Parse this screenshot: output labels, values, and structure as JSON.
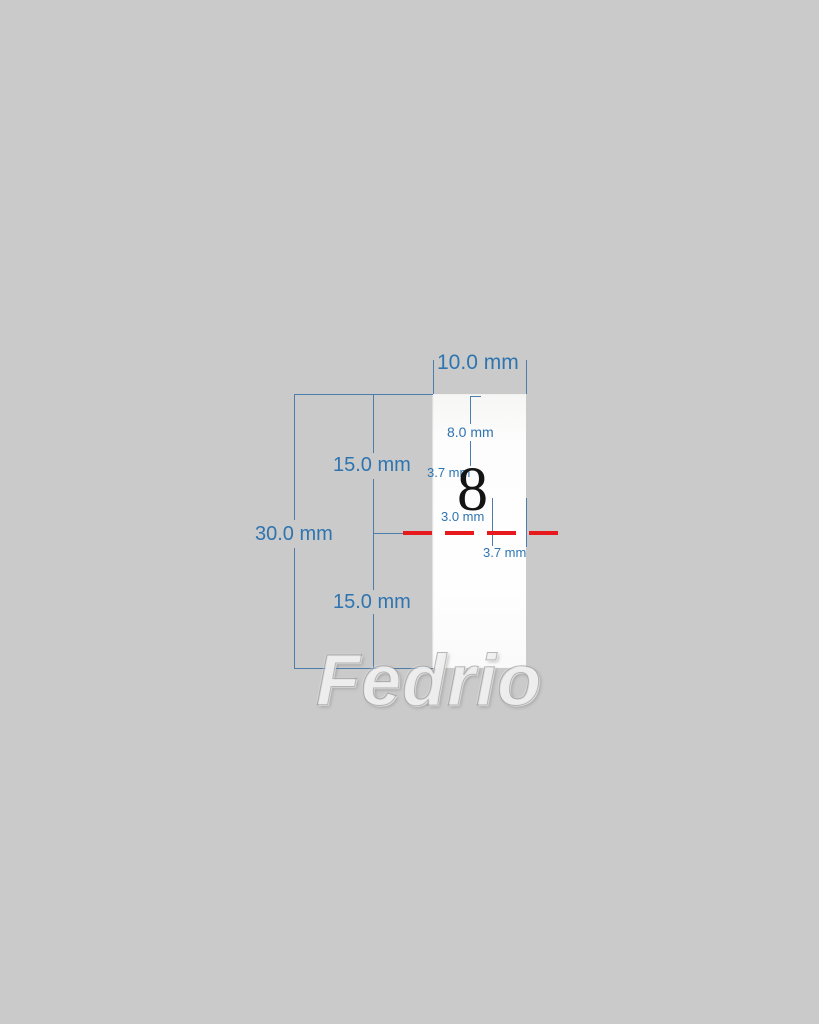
{
  "diagram": {
    "type": "technical-dimension-drawing",
    "part": {
      "number": "8",
      "shape": "vertical rectangular blank"
    },
    "dimensions": {
      "width_top": "10.0 mm",
      "height_upper_half": "15.0 mm",
      "height_total": "30.0 mm",
      "height_lower_half": "15.0 mm",
      "inner_depth": "8.0 mm",
      "offset_upper": "3.7 mm",
      "center_spacing": "3.0 mm",
      "offset_lower": "3.7 mm"
    },
    "watermark": "Fedrio",
    "colors": {
      "background": "#c9cac9",
      "blank_fill": "#fdfdfd",
      "dimension_blue": "#2e74b1",
      "line_blue": "#4d7dab",
      "centerline_red": "#e8191c",
      "part_number_black": "#141414"
    }
  }
}
